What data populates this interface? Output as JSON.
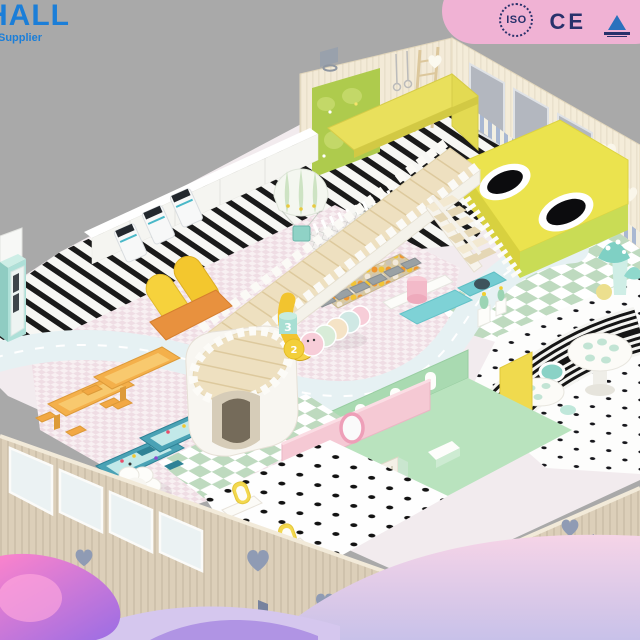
{
  "branding": {
    "logo_text": "HALL",
    "logo_tagline": "Supplier",
    "logo_color": "#1b7ed8"
  },
  "certifications": [
    {
      "id": "iso-badge",
      "label": "ISO"
    },
    {
      "id": "ce-mark",
      "label": "CE"
    },
    {
      "id": "triangle-cert",
      "label": ""
    }
  ],
  "decor_numbers": {
    "three": "3",
    "two": "2"
  },
  "scene": {
    "type": "isometric-3d-render",
    "subject": "indoor kids soft playground floor plan",
    "background_color": "#a9a9a9",
    "zones": [
      {
        "name": "entrance-turnstiles",
        "color": "#f7f8f8"
      },
      {
        "name": "striped-walkway",
        "color": "#161616"
      },
      {
        "name": "vending-kiosk",
        "color": "#a5dbd2"
      },
      {
        "name": "castle-tower",
        "color": "#f8f6f1"
      },
      {
        "name": "wooden-bridge",
        "color": "#eee0c0"
      },
      {
        "name": "ball-pit",
        "color": "#f2c435"
      },
      {
        "name": "hot-air-balloon-decor",
        "color": "#cde3c3"
      },
      {
        "name": "yellow-slides",
        "color": "#f6d23c"
      },
      {
        "name": "trampoline-platform",
        "color": "#ebe34e"
      },
      {
        "name": "climbing-plant-wall",
        "color": "#aecb4d"
      },
      {
        "name": "rope-ladder",
        "color": "#dcc79c"
      },
      {
        "name": "checkerboard-floor",
        "color": "#bedabf"
      },
      {
        "name": "rainbow-arch-tunnel",
        "color": "#161616"
      },
      {
        "name": "cafe-polka-floor",
        "color": "#141418"
      },
      {
        "name": "round-cafe-tables",
        "color": "#fcfbf7"
      },
      {
        "name": "road-track",
        "color": "#e6f1f3"
      },
      {
        "name": "activity-tables-orange",
        "color": "#f4b04b"
      },
      {
        "name": "sand-tables-teal",
        "color": "#4aa2b5"
      },
      {
        "name": "flower-table",
        "color": "#fdfdfa"
      },
      {
        "name": "toddler-mint-room",
        "color": "#b9e3be"
      },
      {
        "name": "dressup-pink-room",
        "color": "#f5c9d4"
      },
      {
        "name": "vanity-mirrors",
        "color": "#f3d84e"
      },
      {
        "name": "caterpillar-soft-toy",
        "color": "#f7cdd8"
      },
      {
        "name": "mushroom-decor",
        "color": "#7fd0c4"
      },
      {
        "name": "outer-walls",
        "color": "#dccfb9"
      }
    ],
    "decor_waves": {
      "pink": "#fb83cc",
      "purple": "#a36fe2",
      "lavender": "#d5c7ee",
      "ribbon_pink": "#f0b2d4"
    }
  }
}
